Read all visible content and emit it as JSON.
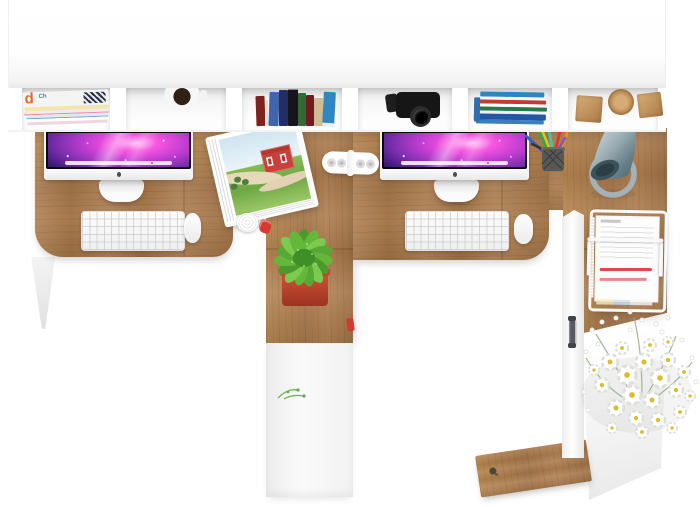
{
  "scene": {
    "description": "Top-down product photo of a white double computer workstation desk with wooden desktop, overhead hutch shelf, two iMac workstations, plant, lamp and accessories on a white background",
    "background_color": "#ffffff",
    "palette": {
      "desk_wood": "#ab7c4f",
      "furniture_white": "#ffffff",
      "panel_gray": "#ededed",
      "screen_magenta": "#f753e0",
      "screen_deep_blue": "#1d0f4e",
      "plant_green": "#63b83c",
      "pot_red": "#c0452f",
      "barn_red": "#c7403a",
      "lamp_steel": "#8ea3aa",
      "daisy_yellow": "#ddba32",
      "highlight_red": "#e0474c"
    }
  },
  "hutch": {
    "label": "white overhead hutch with six open compartments",
    "compartments": [
      {
        "label": "stack of magazines",
        "spine_letter": "d",
        "spine_text": "Ch"
      },
      {
        "label": "white mug with coffee"
      },
      {
        "label": "row of standing books"
      },
      {
        "label": "black camera"
      },
      {
        "label": "horizontal stack of books with blue cover"
      },
      {
        "label": "two wooden cubes and a wooden disc"
      }
    ]
  },
  "desk": {
    "label": "wooden desktop with two workstations",
    "left_workstation": {
      "monitor": "iMac with purple galaxy wallpaper",
      "keyboard": "white wireless keyboard",
      "mouse": "white mouse"
    },
    "right_workstation": {
      "monitor": "iMac with purple galaxy wallpaper",
      "keyboard": "white wireless keyboard",
      "mouse": "white mouse"
    },
    "accessories": {
      "open_magazine": "open magazine showing red barn in green field",
      "cable_organizer": "white cable organizer strip with four holes",
      "paper_roll": "small white paper roll",
      "red_figurine": "small red figurine",
      "pen_cup": "mesh cup with colored pens and pencils",
      "lamp": "steel cone desk lamp with ring base",
      "red_tab": "small red object at pedestal edge"
    }
  },
  "center_pedestal": {
    "label": "center wooden pedestal",
    "plant": "green leafy plant in red square pot",
    "cabinet": "white cabinet front below pedestal",
    "sprig": "small green sprig"
  },
  "right_return": {
    "label": "right desk return with storage cabinet",
    "document_tray": "white wire document tray stacked with papers, two red highlighted lines",
    "flowers": "bouquet of white daisies with yellow centers",
    "cabinet": "white side cabinet",
    "cabinet_handle": "dark metal door handle",
    "side_panel": "white side panel",
    "fallen_panel": "tilted wooden panel with small key"
  },
  "structure": {
    "left_leg": "white angled desk leg",
    "desk_shadow": "soft shadow under hutch"
  }
}
